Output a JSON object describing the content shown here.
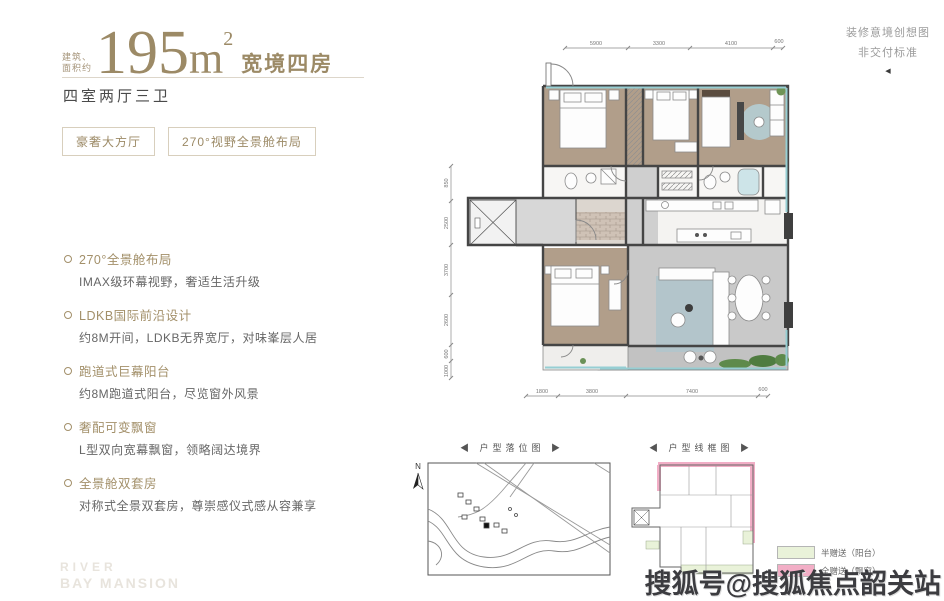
{
  "header": {
    "area_prefix_line1": "建筑、",
    "area_prefix_line2": "面积约",
    "area_value": "195",
    "area_unit": "m",
    "area_exponent": "2",
    "area_tagline": "宽境四房",
    "subtitle": "四室两厅三卫",
    "badges": [
      {
        "label": "豪奢大方厅"
      },
      {
        "label": "270°视野全景舱布局"
      }
    ]
  },
  "features": [
    {
      "title": "270°全景舱布局",
      "desc": "IMAX级环幕视野，奢适生活升级"
    },
    {
      "title": "LDKB国际前沿设计",
      "desc": "约8M开间，LDKB无界宽厅，对味峯层人居"
    },
    {
      "title": "跑道式巨幕阳台",
      "desc": "约8M跑道式阳台，尽览窗外风景"
    },
    {
      "title": "奢配可变飘窗",
      "desc": "L型双向宽幕飘窗，领略阔达境界"
    },
    {
      "title": "全景舱双套房",
      "desc": "对称式全景双套房，尊崇感仪式感从容兼享"
    }
  ],
  "disclaimer": {
    "line1": "装修意境创想图",
    "line2": "非交付标准",
    "arrow": "◀"
  },
  "floorplan": {
    "dims_top": [
      "5900",
      "3300",
      "4100",
      "600"
    ],
    "dims_bottom": [
      "1800",
      "3800",
      "7400",
      "600"
    ],
    "dims_left": [
      "850",
      "2500",
      "3700",
      "2600",
      "600",
      "1000"
    ],
    "dims_right": [
      "600",
      "4300",
      "3700",
      "3500",
      "2100"
    ]
  },
  "figures": {
    "minimap_title": "◀ 户型落位图 ▶",
    "wireframe_title": "◀ 户型线框图 ▶",
    "compass_label": "N"
  },
  "legend": [
    {
      "label": "半赠送（阳台）",
      "color": "#e9f2d9"
    },
    {
      "label": "全赠送（飘窗）",
      "color": "#f2aec6"
    }
  ],
  "watermark": "搜狐号@搜狐焦点韶关站",
  "brand": {
    "line1": "RIVER",
    "line2": "BAY MANSION"
  },
  "colors": {
    "accent_gold": "#9c8a66",
    "wood_floor": "#b19e8a",
    "stone_floor": "#c9c9c9",
    "glass": "#96ced3",
    "legend_pink": "#f2aec6",
    "legend_green": "#e9f2d9"
  }
}
